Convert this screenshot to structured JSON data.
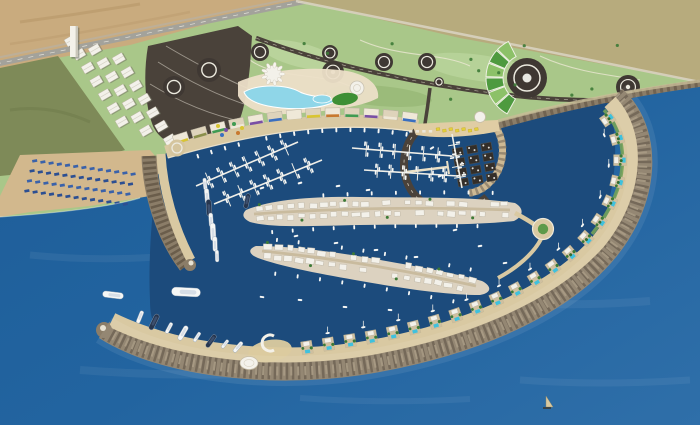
{
  "scene": {
    "title": "Aerial 3D rendering of a crescent-shaped marina resort masterplan on a Mediterranean coastline",
    "view": "bird's-eye visualization, deep blue sea",
    "elements": [
      "patchwork agricultural fields",
      "public park with dark circular plazas",
      "helipad circle with fan-shaped garden",
      "coastal highway and desert land",
      "large dark parking area with roundabouts",
      "hillside white residential blocks",
      "sandy beach with rows of blue sun loungers",
      "lagoon-style swimming pool with pavilions",
      "waterfront promenade buildings with colored awnings",
      "circular cove with ring road and floating platforms",
      "yellow beach umbrellas",
      "marina basin with pontoon berths and boats",
      "two islands densely built with white villas",
      "island roundabout with green center",
      "west breakwater quay with berthed yachts",
      "long curved breakwater with villas, pools and palm trees",
      "amphitheater plaza and round pavilion on breakwater",
      "anchored white superyachts",
      "small sailboats"
    ]
  },
  "colors": {
    "water_left": "#1d5c97",
    "water_mid": "#2264a0",
    "water_open": "#2f6fa9",
    "water_marina": "#1c4b7c",
    "desert": "#c9ab7e",
    "road": "#a3a29b",
    "pavement": "#4a423a",
    "plaza_dark": "#3f3833",
    "park": "#a9c789",
    "lawn_light": "#c0d8a2",
    "lawn_dark": "#8fb06d",
    "field_base": "#b7ab7d",
    "rock": "#8b7d68",
    "rock_dark": "#6a5d4b",
    "rock_light": "#a2937b",
    "sand": "#d2b88d",
    "quay": "#d9c9a2",
    "deck": "#ecdfc8",
    "street": "#c9bb9e",
    "island_base": "#dcd2c0",
    "building": "#f3f1ea",
    "building_edge": "#b9b2a1",
    "shadow": "#6b705f",
    "lagoon": "#8fd6e8",
    "pool": "#3fc1dd",
    "tree": "#3c7a36",
    "olive_lawn": "#7e8a58",
    "boat_white": "#f6f7f5",
    "boat_dark": "#27364e",
    "deck_gray": "#d7dee6",
    "marking_white": "#eceadf",
    "lounger_blue": "#3a62aa",
    "lounger_navy": "#2c4f92",
    "umbrella_yellow": "#e3cf3a",
    "platform_dark": "#332e29",
    "sail_tan": "#d8c9a0"
  },
  "fields": {
    "patch_colors": [
      "#8fae66",
      "#c3b98c",
      "#7ba057",
      "#d6cba0",
      "#9db873",
      "#b4a97c",
      "#6f9a52",
      "#cdc08e",
      "#a3bd79",
      "#8c9e5e",
      "#dbd2a8",
      "#80a85e",
      "#bfb489",
      "#95b06b"
    ]
  },
  "park": {
    "plaza_circles": [
      [
        260,
        52,
        9
      ],
      [
        330,
        53,
        8
      ],
      [
        384,
        62,
        9
      ],
      [
        333,
        72,
        11
      ],
      [
        427,
        62,
        9
      ],
      [
        439,
        82,
        5
      ],
      [
        628,
        87,
        12
      ]
    ],
    "helipad": {
      "cx": 527,
      "cy": 78,
      "r": 20
    },
    "fan": {
      "cx": 527,
      "cy": 78,
      "r1": 24,
      "r2": 41,
      "a1": 118,
      "a2": 244,
      "segments": 6,
      "colors": [
        "#4e9a3f",
        "#8cc168"
      ]
    },
    "trees": 16
  },
  "parking": {
    "roundabouts": [
      [
        174,
        87,
        11
      ],
      [
        209,
        70,
        12
      ]
    ]
  },
  "hillside": {
    "rows": 7,
    "cols": 3
  },
  "beach": {
    "lounger_rows": 4,
    "lounger_cols": 13
  },
  "promenade": {
    "buildings": 13,
    "awning_colors": [
      "#d9c532",
      "#8a8f4a",
      "#3f9b52",
      "#efe8d8",
      "#7a4fa5",
      "#3a6fc0",
      "#efe8d8",
      "#d9c532",
      "#c8792f",
      "#3f9b52",
      "#7a4fa5",
      "#efe8d8",
      "#3a6fc0"
    ],
    "umbrella_dots": [
      [
        218,
        126,
        "#d9c532"
      ],
      [
        226,
        130,
        "#7a4fa5"
      ],
      [
        234,
        124,
        "#3f9b52"
      ],
      [
        242,
        128,
        "#d9c532"
      ],
      [
        222,
        135,
        "#3a6fc0"
      ],
      [
        238,
        133,
        "#c8792f"
      ]
    ],
    "boat_row": 16
  },
  "cove": {
    "platform_grid": {
      "x": 452,
      "y": 149,
      "cols": 3,
      "rows": 4,
      "cw": 14.5,
      "ch": 10.3,
      "rot": -10
    },
    "yellow_umbrellas": 7,
    "white_umbrellas": 4
  },
  "islands": {
    "island1_buildings": 24,
    "island2_buildings": 20,
    "edge_boats": [
      10,
      12,
      10,
      9
    ]
  },
  "pontoons": [
    {
      "x1": 196,
      "y1": 186,
      "x2": 298,
      "y2": 142,
      "fingers": 7,
      "flen": 17
    },
    {
      "x1": 214,
      "y1": 204,
      "x2": 322,
      "y2": 160,
      "fingers": 7,
      "flen": 17
    },
    {
      "x1": 352,
      "y1": 148,
      "x2": 452,
      "y2": 156,
      "fingers": 6,
      "flen": 15
    },
    {
      "x1": 364,
      "y1": 170,
      "x2": 458,
      "y2": 176,
      "fingers": 6,
      "flen": 14
    },
    {
      "x1": 452,
      "y1": 134,
      "x2": 462,
      "y2": 188,
      "fingers": 4,
      "flen": 12
    }
  ],
  "breakwater": {
    "villas": 21,
    "sailboats": 12
  },
  "boats": {
    "tip_yachts": [
      [
        140,
        317,
        13,
        -68,
        0
      ],
      [
        154,
        322,
        17,
        -64,
        1
      ],
      [
        169,
        328,
        12,
        -62,
        0
      ],
      [
        183,
        333,
        16,
        -60,
        0
      ],
      [
        197,
        337,
        11,
        -57,
        0
      ],
      [
        211,
        341,
        15,
        -54,
        1
      ],
      [
        225,
        344,
        10,
        -52,
        0
      ],
      [
        238,
        347,
        13,
        -50,
        0
      ]
    ],
    "west_quay": [
      [
        205,
        184,
        12,
        84,
        0
      ],
      [
        207,
        196,
        15,
        85,
        0
      ],
      [
        209,
        208,
        17,
        86,
        1
      ],
      [
        211,
        220,
        14,
        86,
        0
      ],
      [
        213,
        232,
        18,
        87,
        0
      ],
      [
        215,
        244,
        15,
        88,
        0
      ],
      [
        217,
        256,
        12,
        88,
        0
      ]
    ],
    "anchored": [
      [
        113,
        295,
        21,
        7,
        0
      ],
      [
        186,
        292,
        29,
        3,
        0
      ],
      [
        247,
        201,
        15,
        -78,
        1
      ]
    ],
    "dinghies": [
      [
        262,
        188,
        -20
      ],
      [
        300,
        183,
        -15
      ],
      [
        338,
        186,
        -10
      ],
      [
        368,
        190,
        -8
      ],
      [
        296,
        236,
        -12
      ],
      [
        336,
        243,
        -8
      ],
      [
        376,
        250,
        -6
      ],
      [
        416,
        257,
        -4
      ],
      [
        300,
        300,
        5
      ],
      [
        345,
        307,
        4
      ],
      [
        390,
        310,
        6
      ],
      [
        262,
        297,
        8
      ],
      [
        455,
        230,
        -14
      ],
      [
        480,
        246,
        -10
      ],
      [
        505,
        263,
        -8
      ],
      [
        432,
        148,
        -30
      ],
      [
        440,
        176,
        -25
      ]
    ],
    "small_sailboat": [
      546,
      407
    ]
  }
}
